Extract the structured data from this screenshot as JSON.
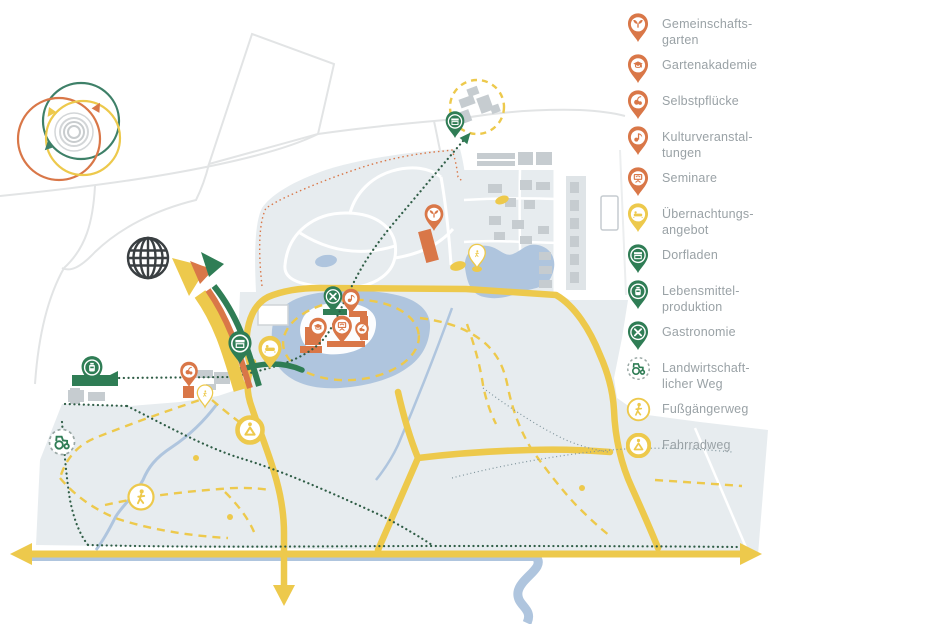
{
  "palette": {
    "orange": "#D97748",
    "yellow": "#EDC94C",
    "green": "#2F7D55",
    "teal": "#3E8068",
    "dark_dot": "#2F5D46",
    "water": "#AFC5DE",
    "land": "#E7ECEF",
    "building_gray": "#C6CCD0",
    "building_light": "#DFE4E7",
    "field_line": "#E2E4E5",
    "text_gray": "#9AA2A6",
    "globe": "#3A3F42"
  },
  "legend": {
    "items": [
      {
        "id": "gemeinschaftsgarten",
        "icon": "sprout-pin-icon",
        "marker": "pin",
        "color": "orange",
        "glyph": "sprout",
        "label": "Gemeinschafts-\ngarten"
      },
      {
        "id": "gartenakademie",
        "icon": "graduation-cap-pin-icon",
        "marker": "pin",
        "color": "orange",
        "glyph": "cap",
        "label": "Gartenakademie"
      },
      {
        "id": "selbstpfluecke",
        "icon": "berries-pin-icon",
        "marker": "pin",
        "color": "orange",
        "glyph": "berries",
        "label": "Selbstpflücke"
      },
      {
        "id": "kulturveranstaltungen",
        "icon": "music-note-pin-icon",
        "marker": "pin",
        "color": "orange",
        "glyph": "note",
        "label": "Kulturveranstal-\ntungen"
      },
      {
        "id": "seminare",
        "icon": "presentation-pin-icon",
        "marker": "pin",
        "color": "orange",
        "glyph": "seminar",
        "label": "Seminare"
      },
      {
        "id": "uebernachtungsangebot",
        "icon": "bed-pin-icon",
        "marker": "pin",
        "color": "yellow",
        "glyph": "bed",
        "label": "Übernachtungs-\nangebot"
      },
      {
        "id": "dorfladen",
        "icon": "shop-pin-icon",
        "marker": "pin",
        "color": "green",
        "glyph": "shop",
        "label": "Dorfladen"
      },
      {
        "id": "lebensmittelproduktion",
        "icon": "jar-pin-icon",
        "marker": "pin",
        "color": "green",
        "glyph": "jar",
        "label": "Lebensmittel-\nproduktion"
      },
      {
        "id": "gastronomie",
        "icon": "crossed-cutlery-pin-icon",
        "marker": "pin",
        "color": "green",
        "glyph": "gastro",
        "label": "Gastronomie"
      },
      {
        "id": "landwirtschaftlicherweg",
        "icon": "tractor-circle-icon",
        "marker": "circle-dashed",
        "color": "green",
        "glyph": "tractor",
        "label": "Landwirtschaft-\nlicher Weg"
      },
      {
        "id": "fussgaengerweg",
        "icon": "pedestrian-circle-icon",
        "marker": "circle-thin",
        "color": "yellow",
        "glyph": "walker",
        "label": "Fußgängerweg"
      },
      {
        "id": "fahrradweg",
        "icon": "cyclist-circle-icon",
        "marker": "circle-thick",
        "color": "yellow",
        "glyph": "cyclist",
        "label": "Fahrradweg"
      }
    ]
  },
  "map": {
    "pins": [
      {
        "type": "dorfladen",
        "x": 455,
        "y": 138,
        "scale": 0.85
      },
      {
        "type": "gemeinschaftsgarten",
        "x": 434,
        "y": 231,
        "scale": 0.85
      },
      {
        "type": "wegpunkt",
        "x": 477,
        "y": 268,
        "scale": 0.75,
        "variant": "pale"
      },
      {
        "type": "gastronomie",
        "x": 333,
        "y": 313,
        "scale": 0.85
      },
      {
        "type": "kulturveranstaltungen",
        "x": 351,
        "y": 314,
        "scale": 0.8
      },
      {
        "type": "gartenakademie",
        "x": 318,
        "y": 343,
        "scale": 0.8
      },
      {
        "type": "seminare",
        "x": 342,
        "y": 344,
        "scale": 0.9
      },
      {
        "type": "selbstpfluecke",
        "x": 362,
        "y": 341,
        "scale": 0.62
      },
      {
        "type": "dorfladen",
        "x": 240,
        "y": 364,
        "scale": 1.05
      },
      {
        "type": "uebernachtungsangebot",
        "x": 270,
        "y": 369,
        "scale": 1.05
      },
      {
        "type": "lebensmittelproduktion",
        "x": 92,
        "y": 386,
        "scale": 0.95
      },
      {
        "type": "selbstpfluecke",
        "x": 189,
        "y": 387,
        "scale": 0.8
      },
      {
        "type": "wegpunkt",
        "x": 205,
        "y": 407,
        "scale": 0.7,
        "variant": "pale"
      }
    ],
    "way_markers": [
      {
        "type": "landwirtschaftlicherweg",
        "glyph": "tractor",
        "ring": "dashed",
        "x": 62,
        "y": 442
      },
      {
        "type": "fussgaengerweg",
        "glyph": "walker",
        "ring": "thin",
        "x": 141,
        "y": 497
      },
      {
        "type": "fahrradweg",
        "glyph": "cyclist",
        "ring": "thick",
        "x": 250,
        "y": 430
      }
    ]
  }
}
